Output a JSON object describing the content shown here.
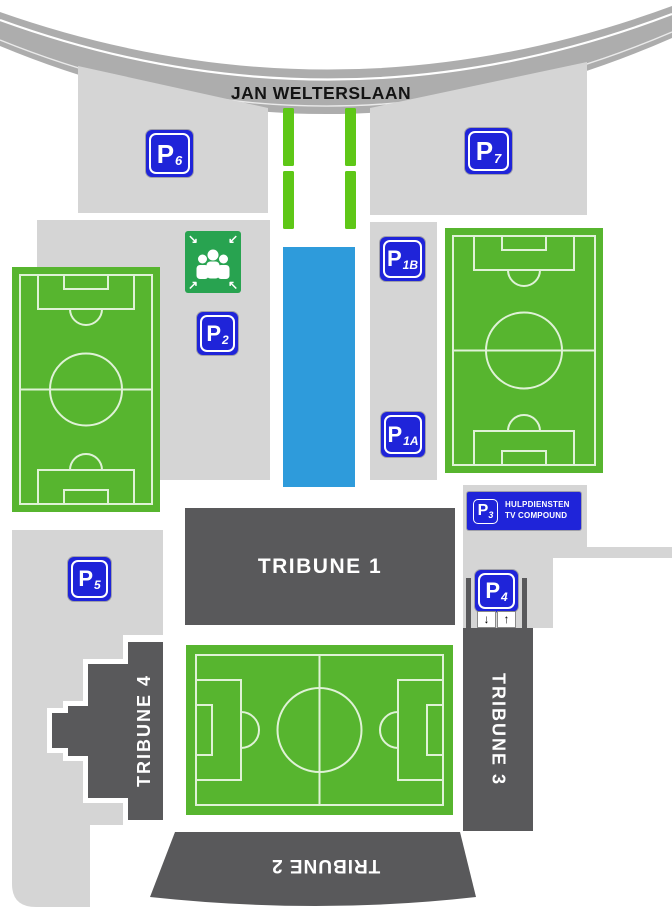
{
  "road": {
    "label": "JAN WELTERSLAAN"
  },
  "signs": {
    "p6": {
      "letter": "P",
      "number": "6"
    },
    "p7": {
      "letter": "P",
      "number": "7"
    },
    "p2": {
      "letter": "P",
      "number": "2"
    },
    "p1b": {
      "letter": "P",
      "number": "1B"
    },
    "p1a": {
      "letter": "P",
      "number": "1A"
    },
    "p5": {
      "letter": "P",
      "number": "5"
    },
    "p3": {
      "letter": "P",
      "number": "3"
    },
    "p4": {
      "letter": "P",
      "number": "4"
    }
  },
  "p3_annex": {
    "line1": "HULPDIENSTEN",
    "line2": "TV COMPOUND"
  },
  "tribunes": {
    "t1": "TRIBUNE 1",
    "t2": "TRIBUNE 2",
    "t3": "TRIBUNE 3",
    "t4": "TRIBUNE 4"
  },
  "gate": {
    "down": "↓",
    "up": "↑"
  },
  "assembly_icon": {
    "tl": "↘",
    "tr": "↙",
    "bl": "↗",
    "br": "↖"
  },
  "colors": {
    "sign_blue": "#1F24D9",
    "field_green": "#57B52F",
    "field_line": "#DFF2D6",
    "strip_green": "#5EC717",
    "water_blue": "#2E9BDB",
    "area_gray": "#D5D5D5",
    "road_gray": "#ADADAD",
    "tribune_gray": "#59595B",
    "assembly_green": "#28A350"
  }
}
